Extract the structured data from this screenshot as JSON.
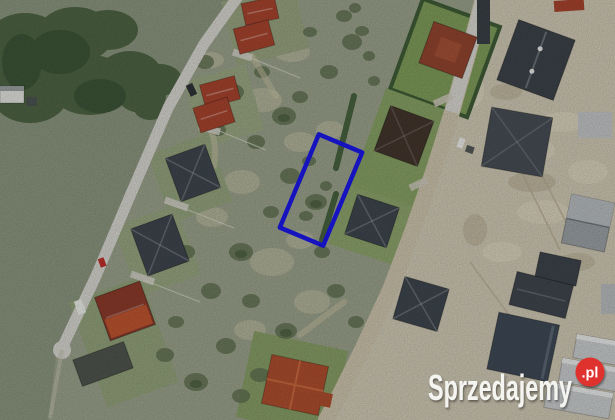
{
  "watermark": {
    "brand": "Sprzedajemy",
    "tld": ".pl",
    "text_color": "#f4f4f1",
    "badge_color": "#df312e",
    "badge_text_color": "#ffffff"
  },
  "plot_highlight": {
    "stroke": "#1b18ea"
  },
  "palette": {
    "field": "#8b957f",
    "scrub": "#9ba28c",
    "dirt": "#cfc8b4",
    "road_paved": "#d7d6d0",
    "road_gravel": "#cdc4ac",
    "tree": "#49603f",
    "bush": "#5f7050",
    "lawn": "#7f9c5a",
    "hedge": "#3f5c36",
    "roof_red": "#a8442e",
    "roof_slate": "#3e464e",
    "roof_brown": "#93452f",
    "roof_dark_brown": "#44362d",
    "farm_roof_dark": "#8c3b2b",
    "farm_roof_orange": "#bf5530",
    "roof_red_large": "#ae4e2e",
    "newbuild_dark": "#3c4349",
    "newbuild_gray": "#9aa0a4",
    "building_navy": "#3f4a56",
    "rowhouse": "#c9cccd",
    "concrete": "#c3c5c6",
    "vehicle_white": "#eceee9",
    "vehicle_red": "#c03028",
    "vehicle_dark": "#2f3338"
  }
}
